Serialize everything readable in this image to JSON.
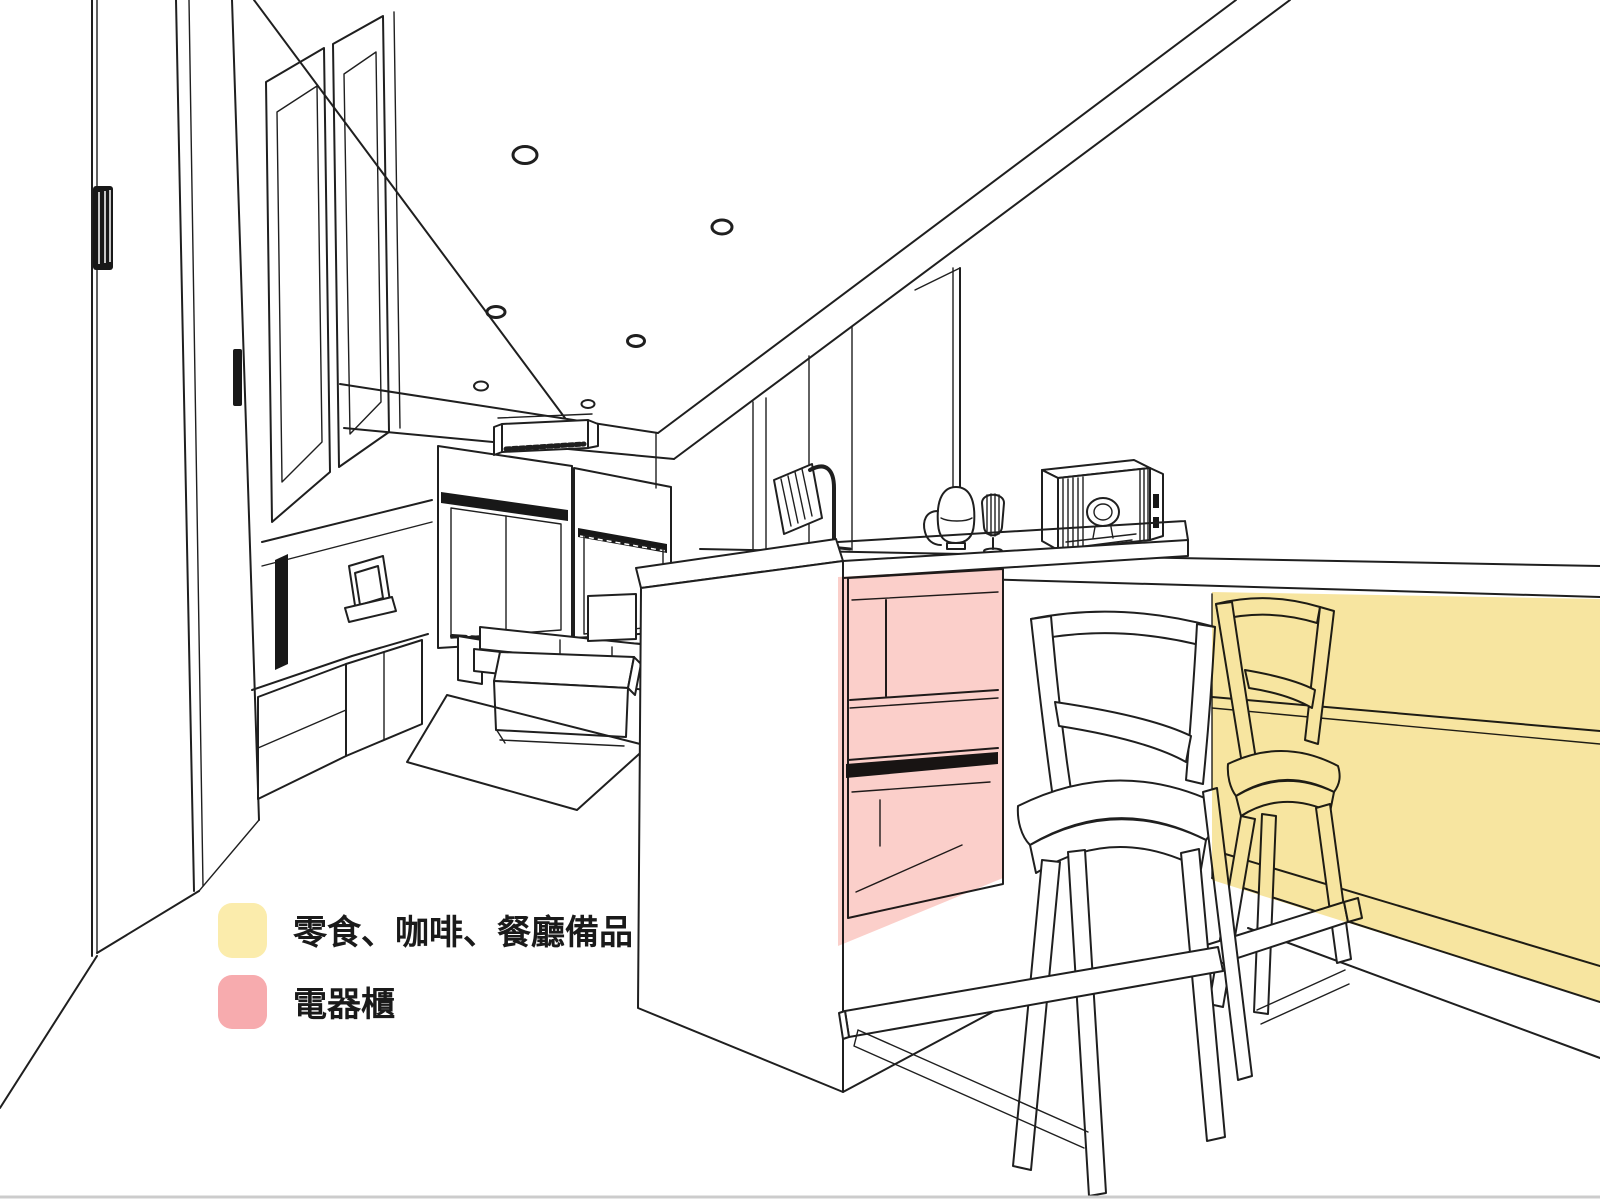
{
  "canvas": {
    "width": 1600,
    "height": 1200,
    "background_color": "#ffffff",
    "line_color": "#1f1f1f",
    "baseline_color": "#cccccc"
  },
  "legend": {
    "items": [
      {
        "id": "snacks-coffee-dining-supplies",
        "label": "零食、咖啡、餐廳備品",
        "swatch_color": "#FBECAC",
        "region_color": "#F7E49B"
      },
      {
        "id": "appliance-cabinet",
        "label": "電器櫃",
        "swatch_color": "#F7ABAE",
        "region_color": "#FBCDC7"
      }
    ]
  }
}
